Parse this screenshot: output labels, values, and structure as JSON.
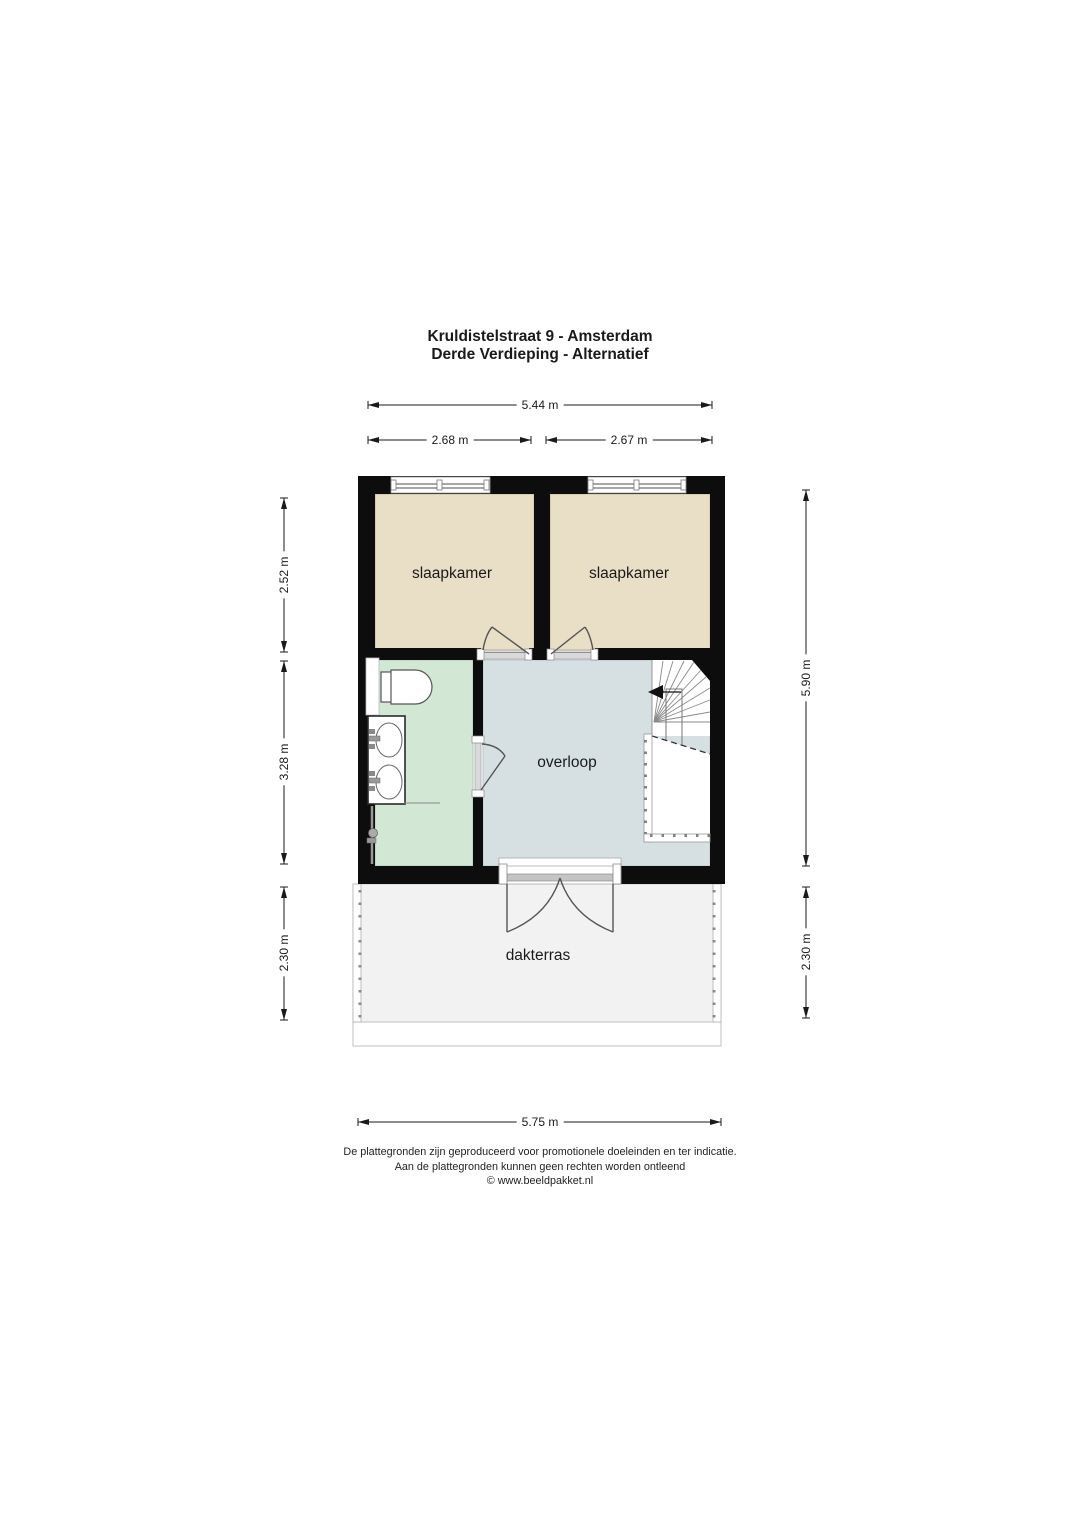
{
  "title": {
    "line1": "Kruldistelstraat 9 - Amsterdam",
    "line2": "Derde Verdieping - Alternatief"
  },
  "dimensions": {
    "top_total": "5.44 m",
    "top_left_room": "2.68 m",
    "top_right_room": "2.67 m",
    "left_bedrooms": "2.52 m",
    "left_middle": "3.28 m",
    "left_terrace": "2.30 m",
    "right_house": "5.90 m",
    "right_terrace": "2.30 m",
    "bottom_total": "5.75 m"
  },
  "rooms": {
    "bedroom_left": "slaapkamer",
    "bedroom_right": "slaapkamer",
    "landing": "overloop",
    "roof_terrace": "dakterras"
  },
  "footer": {
    "line1": "De plattegronden zijn geproduceerd voor promotionele doeleinden en ter indicatie.",
    "line2": "Aan de plattegronden kunnen geen rechten worden ontleend",
    "line3": "© www.beeldpakket.nl"
  },
  "colors": {
    "wall": "#0d0d0d",
    "bedroom_fill": "#e9dfc6",
    "bathroom_fill": "#d2e7d4",
    "landing_fill": "#d6e0e2",
    "terrace_fill": "#f2f2f2"
  }
}
